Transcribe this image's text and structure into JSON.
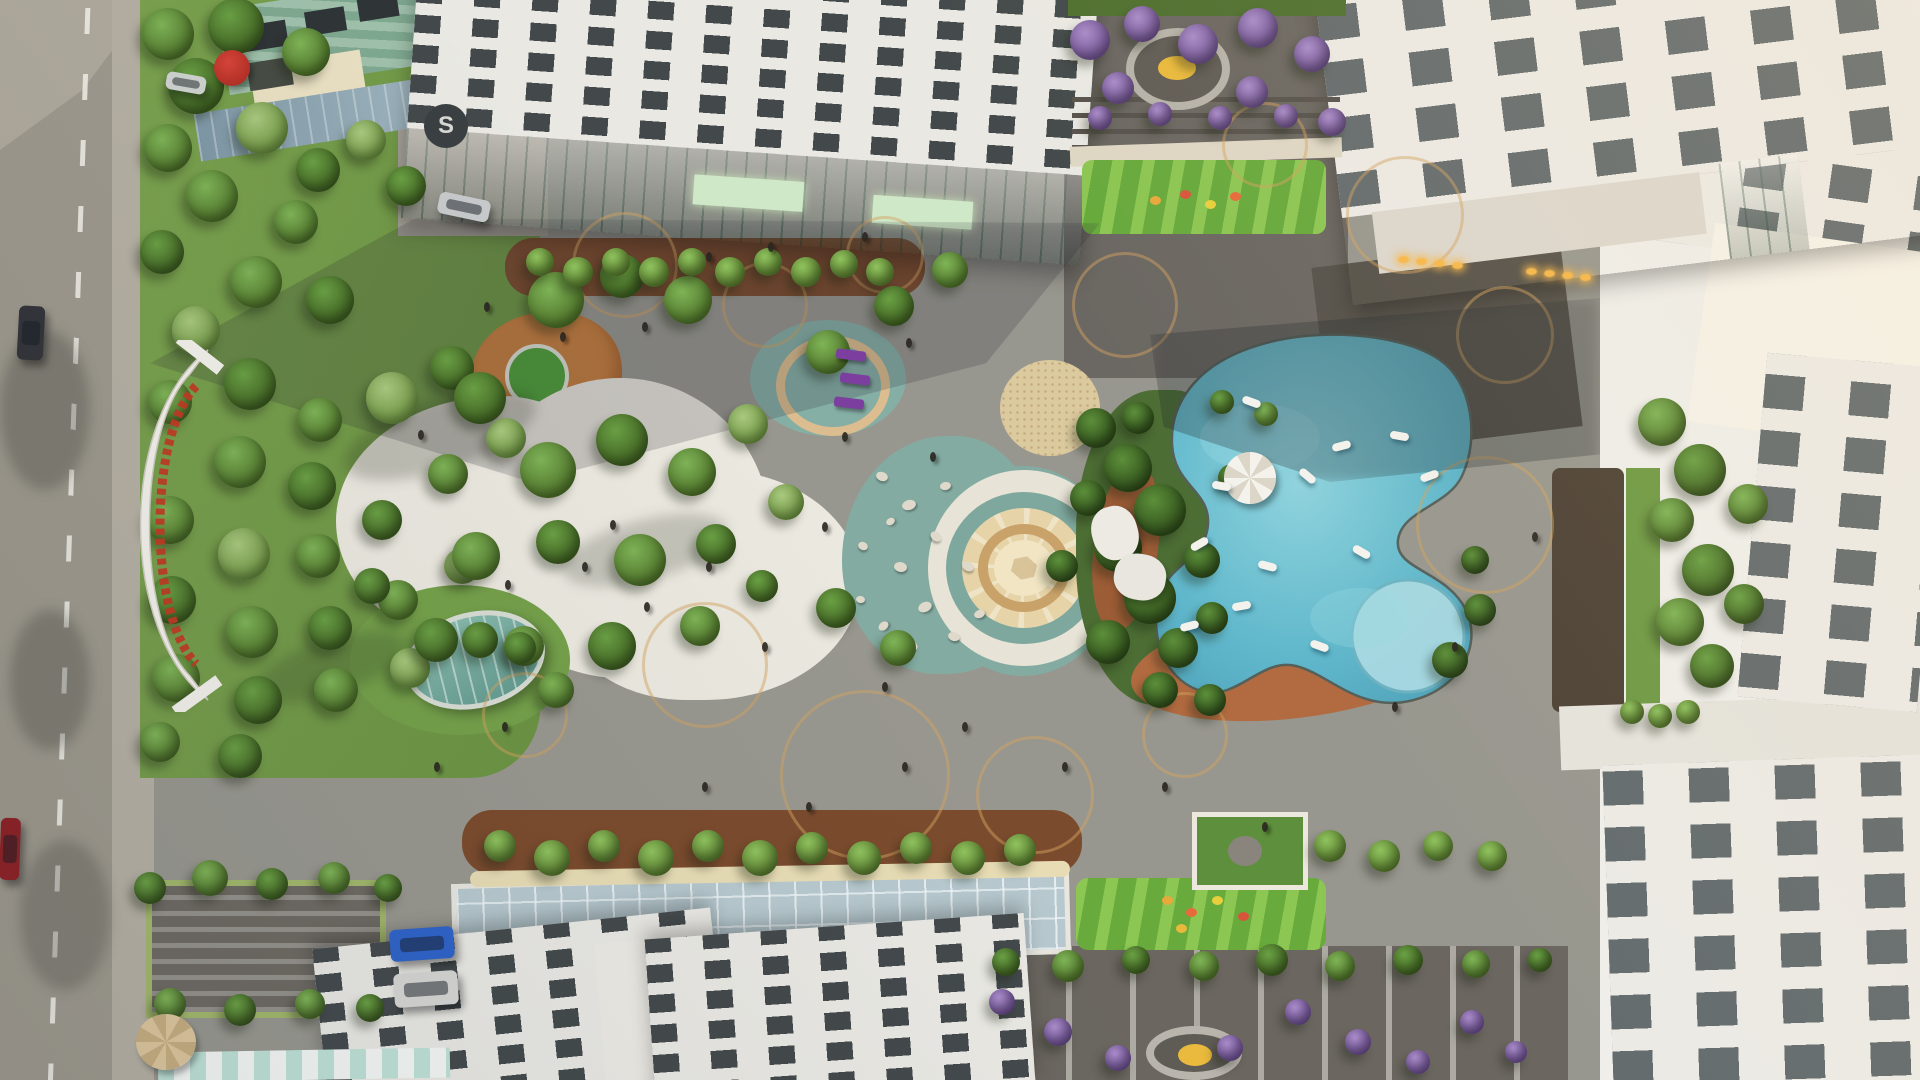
{
  "meta": {
    "description": "Aerial top-down 3D architectural rendering of a residential apartment complex courtyard: landscaped gardens, white stone plaza, circular mosaic medallion court, free-form swimming pool with floats, playgrounds, rooftop terraces and surrounding white towers; perimeter road with cars on the left.",
    "time_of_day": "late afternoon, long diagonal building shadows"
  },
  "entrance_sign": {
    "description": "curved white entrance canopy with red project-name lettering along the arc",
    "text_legible": false,
    "lettering_color": "#c23a22"
  },
  "logo": {
    "letter": "S"
  },
  "colors": {
    "road": "#9e998d",
    "sidewalk": "#b6b0a3",
    "plaza_gray": "#98978f",
    "plaza_white": "#ebe8df",
    "teal_surface": "#83aba1",
    "medallion_cream": "#e6d4a8",
    "pool_water": "#5fb5c9",
    "pool_shallow": "#a7d9e2",
    "pool_deck_terracotta": "#b26b40",
    "lawn": "#74a049",
    "playground_orange": "#c9803f",
    "playground_green": "#68aa3b",
    "building_white": "#e9e8e3",
    "glass_green": "#9dc3b3",
    "terrace_dark": "#6b6762",
    "purple_bloom": "#8f6cb4",
    "paving_ring_tan": "#d4a260",
    "tree_variants": [
      [
        "#7fb457",
        "#4e7328"
      ],
      [
        "#6aa044",
        "#3f6120"
      ],
      [
        "#a9c97f",
        "#6d9440"
      ],
      [
        "#5c8f3a",
        "#2f4d1a"
      ],
      [
        "#a98cc9",
        "#6d4f92"
      ],
      [
        "#8fc25e",
        "#5a7f2e"
      ]
    ]
  },
  "scene": {
    "trees": [
      [
        168,
        34,
        26,
        0
      ],
      [
        236,
        26,
        28,
        1
      ],
      [
        306,
        52,
        24,
        0
      ],
      [
        196,
        86,
        28,
        1
      ],
      [
        168,
        148,
        24,
        0
      ],
      [
        262,
        128,
        26,
        2
      ],
      [
        318,
        170,
        22,
        1
      ],
      [
        212,
        196,
        26,
        0
      ],
      [
        162,
        252,
        22,
        1
      ],
      [
        296,
        222,
        22,
        0
      ],
      [
        366,
        140,
        20,
        2
      ],
      [
        406,
        186,
        20,
        1
      ],
      [
        256,
        282,
        26,
        0
      ],
      [
        330,
        300,
        24,
        1
      ],
      [
        196,
        330,
        24,
        2
      ],
      [
        170,
        402,
        22,
        0
      ],
      [
        250,
        384,
        26,
        1
      ],
      [
        320,
        420,
        22,
        0
      ],
      [
        392,
        398,
        26,
        2
      ],
      [
        452,
        368,
        22,
        1
      ],
      [
        240,
        462,
        26,
        0
      ],
      [
        312,
        486,
        24,
        1
      ],
      [
        170,
        520,
        24,
        0
      ],
      [
        244,
        554,
        26,
        2
      ],
      [
        318,
        556,
        22,
        0
      ],
      [
        382,
        520,
        20,
        1
      ],
      [
        448,
        474,
        20,
        0
      ],
      [
        506,
        438,
        20,
        2
      ],
      [
        172,
        600,
        24,
        1
      ],
      [
        252,
        632,
        26,
        0
      ],
      [
        330,
        628,
        22,
        1
      ],
      [
        398,
        600,
        20,
        0
      ],
      [
        462,
        566,
        18,
        2
      ],
      [
        176,
        678,
        24,
        0
      ],
      [
        258,
        700,
        24,
        1
      ],
      [
        336,
        690,
        22,
        0
      ],
      [
        410,
        668,
        20,
        2
      ],
      [
        480,
        640,
        18,
        1
      ],
      [
        160,
        742,
        20,
        0
      ],
      [
        240,
        756,
        22,
        1
      ],
      [
        480,
        398,
        26,
        1
      ],
      [
        556,
        300,
        28,
        0
      ],
      [
        622,
        276,
        22,
        1
      ],
      [
        688,
        300,
        24,
        0
      ],
      [
        548,
        470,
        28,
        0
      ],
      [
        622,
        440,
        26,
        1
      ],
      [
        692,
        472,
        24,
        0
      ],
      [
        748,
        424,
        20,
        2
      ],
      [
        476,
        556,
        24,
        0
      ],
      [
        558,
        542,
        22,
        1
      ],
      [
        640,
        560,
        26,
        0
      ],
      [
        716,
        544,
        20,
        1
      ],
      [
        786,
        502,
        18,
        2
      ],
      [
        436,
        640,
        22,
        1
      ],
      [
        524,
        646,
        20,
        0
      ],
      [
        612,
        646,
        24,
        1
      ],
      [
        700,
        626,
        20,
        0
      ],
      [
        762,
        586,
        16,
        1
      ],
      [
        828,
        352,
        22,
        0
      ],
      [
        894,
        306,
        20,
        1
      ],
      [
        950,
        270,
        18,
        0
      ],
      [
        836,
        608,
        20,
        1
      ],
      [
        898,
        648,
        18,
        0
      ],
      [
        1096,
        428,
        20,
        3
      ],
      [
        1128,
        468,
        24,
        3
      ],
      [
        1160,
        510,
        26,
        3
      ],
      [
        1118,
        548,
        24,
        3
      ],
      [
        1150,
        598,
        26,
        3
      ],
      [
        1108,
        642,
        22,
        3
      ],
      [
        1178,
        648,
        20,
        3
      ],
      [
        1202,
        560,
        18,
        3
      ],
      [
        1088,
        498,
        18,
        3
      ],
      [
        1138,
        418,
        16,
        3
      ],
      [
        1212,
        618,
        16,
        3
      ],
      [
        1232,
        478,
        14,
        3
      ],
      [
        1062,
        566,
        16,
        3
      ],
      [
        1160,
        690,
        18,
        3
      ],
      [
        1210,
        700,
        16,
        3
      ],
      [
        1450,
        660,
        18,
        3
      ],
      [
        1480,
        610,
        16,
        3
      ],
      [
        1475,
        560,
        14,
        3
      ],
      [
        1662,
        422,
        24,
        0
      ],
      [
        1700,
        470,
        26,
        1
      ],
      [
        1672,
        520,
        22,
        0
      ],
      [
        1708,
        570,
        26,
        1
      ],
      [
        1680,
        622,
        24,
        0
      ],
      [
        1712,
        666,
        22,
        1
      ],
      [
        1748,
        504,
        20,
        0
      ],
      [
        1744,
        604,
        20,
        1
      ],
      [
        1090,
        40,
        20,
        4
      ],
      [
        1142,
        24,
        18,
        4
      ],
      [
        1198,
        44,
        20,
        4
      ],
      [
        1258,
        28,
        20,
        4
      ],
      [
        1312,
        54,
        18,
        4
      ],
      [
        1252,
        92,
        16,
        4
      ],
      [
        1118,
        88,
        16,
        4
      ],
      [
        1332,
        122,
        14,
        4
      ],
      [
        1100,
        118,
        12,
        4
      ],
      [
        1160,
        114,
        12,
        4
      ],
      [
        1220,
        118,
        12,
        4
      ],
      [
        1286,
        116,
        12,
        4
      ],
      [
        540,
        262,
        14,
        5
      ],
      [
        578,
        272,
        15,
        5
      ],
      [
        616,
        262,
        14,
        5
      ],
      [
        654,
        272,
        15,
        5
      ],
      [
        692,
        262,
        14,
        5
      ],
      [
        730,
        272,
        15,
        5
      ],
      [
        768,
        262,
        14,
        5
      ],
      [
        806,
        272,
        15,
        5
      ],
      [
        844,
        264,
        14,
        5
      ],
      [
        880,
        272,
        14,
        5
      ],
      [
        500,
        846,
        16,
        5
      ],
      [
        552,
        858,
        18,
        5
      ],
      [
        604,
        846,
        16,
        5
      ],
      [
        656,
        858,
        18,
        5
      ],
      [
        708,
        846,
        16,
        5
      ],
      [
        760,
        858,
        18,
        5
      ],
      [
        812,
        848,
        16,
        5
      ],
      [
        864,
        858,
        17,
        5
      ],
      [
        916,
        848,
        16,
        5
      ],
      [
        968,
        858,
        17,
        5
      ],
      [
        1020,
        850,
        16,
        5
      ],
      [
        1330,
        846,
        16,
        5
      ],
      [
        1384,
        856,
        16,
        5
      ],
      [
        1438,
        846,
        15,
        5
      ],
      [
        1492,
        856,
        15,
        5
      ],
      [
        1006,
        962,
        14,
        1
      ],
      [
        1068,
        966,
        16,
        0
      ],
      [
        1136,
        960,
        14,
        1
      ],
      [
        1204,
        966,
        15,
        0
      ],
      [
        1272,
        960,
        16,
        1
      ],
      [
        1340,
        966,
        15,
        0
      ],
      [
        1408,
        960,
        15,
        1
      ],
      [
        1476,
        964,
        14,
        0
      ],
      [
        1540,
        960,
        12,
        1
      ],
      [
        1002,
        1002,
        13,
        4
      ],
      [
        1058,
        1032,
        14,
        4
      ],
      [
        1118,
        1058,
        13,
        4
      ],
      [
        1298,
        1012,
        13,
        4
      ],
      [
        1358,
        1042,
        13,
        4
      ],
      [
        1418,
        1062,
        12,
        4
      ],
      [
        1472,
        1022,
        12,
        4
      ],
      [
        1230,
        1048,
        13,
        4
      ],
      [
        1516,
        1052,
        11,
        4
      ],
      [
        150,
        888,
        16,
        1
      ],
      [
        210,
        878,
        18,
        0
      ],
      [
        272,
        884,
        16,
        1
      ],
      [
        334,
        878,
        16,
        0
      ],
      [
        388,
        888,
        14,
        1
      ],
      [
        170,
        1004,
        16,
        0
      ],
      [
        240,
        1010,
        16,
        1
      ],
      [
        310,
        1004,
        15,
        0
      ],
      [
        370,
        1008,
        14,
        1
      ],
      [
        372,
        586,
        18,
        1
      ],
      [
        520,
        648,
        16,
        1
      ],
      [
        556,
        690,
        18,
        0
      ],
      [
        1222,
        402,
        12,
        1
      ],
      [
        1266,
        414,
        12,
        0
      ],
      [
        1632,
        712,
        12,
        5
      ],
      [
        1660,
        716,
        12,
        5
      ],
      [
        1688,
        712,
        12,
        5
      ]
    ],
    "cars": [
      [
        18,
        306,
        26,
        54,
        "#33343a",
        3,
        "suv-dark-road"
      ],
      [
        0,
        818,
        20,
        62,
        "#8e2125",
        2,
        "car-red-road"
      ],
      [
        438,
        196,
        52,
        22,
        "#c7c9cb",
        12,
        "car-silver-driveway"
      ],
      [
        166,
        74,
        40,
        18,
        "#cfd2cf",
        10,
        "car-white-top"
      ],
      [
        390,
        928,
        64,
        32,
        "#2f63c9",
        -4,
        "car-blue-parked"
      ],
      [
        394,
        972,
        64,
        34,
        "#d6d6d3",
        -4,
        "car-white-parked"
      ]
    ],
    "pool_floats": [
      [
        1242,
        398,
        20
      ],
      [
        1332,
        442,
        -15
      ],
      [
        1298,
        472,
        40
      ],
      [
        1212,
        482,
        10
      ],
      [
        1190,
        540,
        -30
      ],
      [
        1258,
        562,
        15
      ],
      [
        1232,
        602,
        -10
      ],
      [
        1352,
        548,
        30
      ],
      [
        1420,
        472,
        -20
      ],
      [
        1390,
        432,
        10
      ],
      [
        1310,
        642,
        20
      ],
      [
        1180,
        622,
        -15
      ]
    ],
    "people": [
      [
        706,
        252
      ],
      [
        768,
        242
      ],
      [
        862,
        232
      ],
      [
        906,
        338
      ],
      [
        642,
        322
      ],
      [
        560,
        332
      ],
      [
        484,
        302
      ],
      [
        842,
        432
      ],
      [
        930,
        452
      ],
      [
        822,
        522
      ],
      [
        706,
        562
      ],
      [
        644,
        602
      ],
      [
        582,
        562
      ],
      [
        762,
        642
      ],
      [
        882,
        682
      ],
      [
        962,
        722
      ],
      [
        1062,
        762
      ],
      [
        1162,
        782
      ],
      [
        1262,
        822
      ],
      [
        902,
        762
      ],
      [
        806,
        802
      ],
      [
        702,
        782
      ],
      [
        502,
        722
      ],
      [
        434,
        762
      ],
      [
        1392,
        702
      ],
      [
        1452,
        642
      ],
      [
        1532,
        532
      ],
      [
        418,
        430
      ],
      [
        505,
        580
      ],
      [
        610,
        520
      ]
    ],
    "paving_rings": [
      [
        622,
        262,
        50
      ],
      [
        762,
        302,
        40
      ],
      [
        882,
        252,
        36
      ],
      [
        702,
        662,
        60
      ],
      [
        862,
        772,
        82
      ],
      [
        1032,
        792,
        56
      ],
      [
        1182,
        732,
        40
      ],
      [
        1482,
        522,
        66
      ],
      [
        1502,
        332,
        46
      ],
      [
        1402,
        212,
        56
      ],
      [
        1122,
        302,
        50
      ],
      [
        522,
        712,
        40
      ],
      [
        1262,
        142,
        40
      ]
    ],
    "pebbles": [
      [
        876,
        472,
        12,
        9,
        20
      ],
      [
        902,
        500,
        14,
        10,
        -15
      ],
      [
        930,
        532,
        12,
        9,
        40
      ],
      [
        894,
        562,
        13,
        10,
        10
      ],
      [
        918,
        602,
        14,
        10,
        -25
      ],
      [
        948,
        632,
        12,
        9,
        15
      ],
      [
        878,
        622,
        11,
        8,
        -40
      ],
      [
        858,
        542,
        10,
        8,
        25
      ],
      [
        940,
        482,
        11,
        8,
        -10
      ],
      [
        962,
        562,
        12,
        9,
        30
      ],
      [
        974,
        610,
        11,
        8,
        -20
      ],
      [
        908,
        642,
        10,
        8,
        45
      ],
      [
        856,
        596,
        9,
        7,
        10
      ],
      [
        886,
        518,
        9,
        7,
        -30
      ]
    ],
    "loungers": [
      [
        836,
        350
      ],
      [
        840,
        374
      ],
      [
        834,
        398
      ]
    ],
    "flower_dots": [
      [
        1162,
        896,
        "#e8a93c"
      ],
      [
        1186,
        908,
        "#e86a3c"
      ],
      [
        1212,
        896,
        "#e8cf3c"
      ],
      [
        1238,
        912,
        "#d8553c"
      ],
      [
        1176,
        924,
        "#e8b93c"
      ],
      [
        1150,
        196,
        "#e8a93c"
      ],
      [
        1180,
        190,
        "#d8553c"
      ],
      [
        1205,
        200,
        "#e8cf3c"
      ],
      [
        1230,
        192,
        "#e86a3c"
      ]
    ],
    "entrance_lights": [
      [
        1398,
        256
      ],
      [
        1416,
        258
      ],
      [
        1434,
        260
      ],
      [
        1452,
        262
      ],
      [
        1526,
        268
      ],
      [
        1544,
        270
      ],
      [
        1562,
        272
      ],
      [
        1580,
        274
      ]
    ]
  }
}
